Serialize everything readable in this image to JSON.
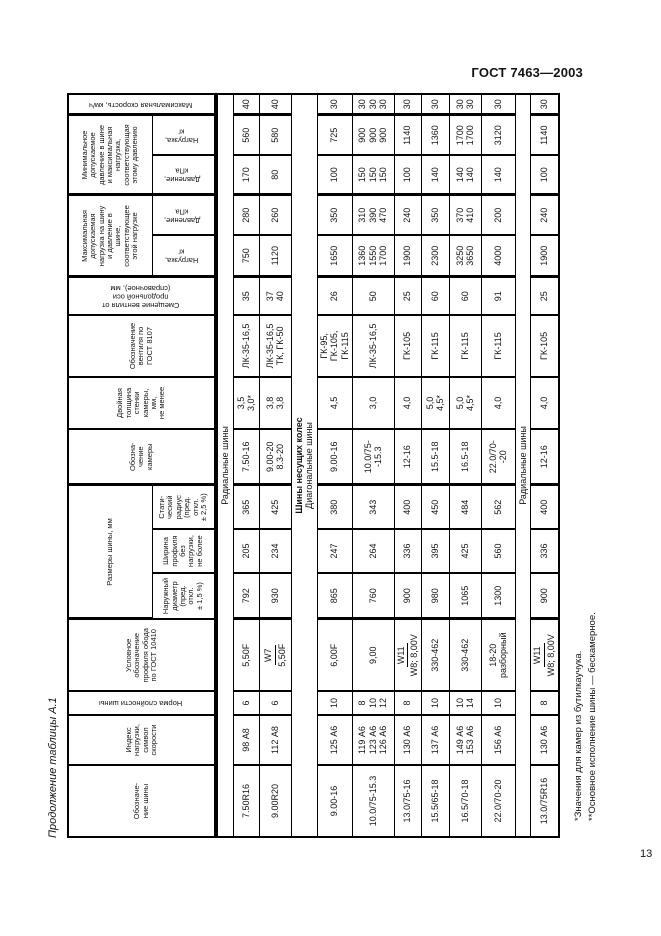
{
  "page": {
    "standard_ref": "ГОСТ 7463—2003",
    "page_number": "13"
  },
  "table": {
    "caption": "Продолжение таблицы А.1",
    "headers": {
      "tire_designation": "Обозначе-\nние шины",
      "load_index": "Индекс\nнагрузки,\nсимвол\nскорости",
      "ply_rating": "Норма слойности шины",
      "rim_profile": "Условное\nобозначение\nпрофиля обода\nпо ГОСТ 10410",
      "tire_dimensions_group": "Размеры шины, мм",
      "outer_diameter": "Наружный\nдиаметр\n(пред.\nоткл.\n± 1,5 %)",
      "profile_width": "Ширина\nпрофиля\nбез\nнагрузки,\nне более",
      "static_radius": "Стати-\nческий\nрадиус\n(пред.\nоткл.\n± 2,5 %)",
      "tube_designation": "Обозна-\nчение\nкамеры",
      "tube_wall_thickness": "Двойная\nтолщина\nстенки\nкамеры,\nмм,\nне менее",
      "valve_designation": "Обозначение\nвентиля по\nГОСТ 8107",
      "valve_offset": "Смещение вентиля от\nпродольной оси\n(справочное), мм",
      "max_load_group": "Максимальная\nдопускаемая\nнагрузка на шину\nи давление в\nшине,\nсоответствующее\nэтой нагрузке",
      "min_pressure_group": "Минимальное\nдопускаемое\nдавление в шине\nи максимальная\nнагрузка,\nсоответствующая\nэтому давлению",
      "load_kg_max": "Нагрузка,\nкг",
      "pressure_kpa_max": "Давление,\nкПа",
      "pressure_kpa_min": "Давление,\nкПа",
      "load_kg_min": "Нагрузка,\nкг",
      "max_speed": "Максимальная скорость, км/ч"
    },
    "rows": [
      {
        "section": [
          {
            "text": "Радиальные шины",
            "bold": false
          }
        ],
        "h": 14
      },
      {
        "h": 26,
        "cells": [
          "7.50R16",
          "98 А8",
          "6",
          "5,50F",
          "792",
          "205",
          "365",
          "7.50-16",
          "3,5\n3,0*",
          "ЛК-35-16,5",
          "35",
          "750",
          "280",
          "170",
          "560",
          "40"
        ]
      },
      {
        "h": 32,
        "cells": [
          "9.00R20",
          "112 А8",
          "6",
          {
            "frac": [
              "W7",
              "5,50F"
            ]
          },
          "930",
          "234",
          "425",
          "9.00-20\n8.3-20",
          "3,8\n3,8",
          "ЛК-35-16,5\nТК, ГК-50",
          "37\n40",
          "1120",
          "260",
          "80",
          "580",
          "40"
        ]
      },
      {
        "section": [
          {
            "text": "Шины несущих колес",
            "bold": true
          },
          {
            "text": "Диагональные шины",
            "bold": false
          }
        ],
        "h": 24
      },
      {
        "h": 32,
        "cells": [
          "9.00-16",
          "125 А6",
          "10",
          "6,00F",
          "865",
          "247",
          "380",
          "9.00-16",
          "4,5",
          "ГК-95,\nГК-105,\nГК-115",
          "26",
          "1650",
          "350",
          "100",
          "725",
          "30"
        ]
      },
      {
        "h": 42,
        "cells": [
          "10.0/75-15.3",
          "119 А6\n123 А6\n126 А6",
          "8\n10\n12",
          "9,00",
          "760",
          "264",
          "343",
          "10.0/75-\n-15.3",
          "3,0",
          "ЛК-35-16,5",
          "50",
          "1360\n1550\n1700",
          "310\n390\n470",
          "150\n150\n150",
          "900\n900\n900",
          "30\n30\n30"
        ]
      },
      {
        "h": 26,
        "cells": [
          "13.0/75-16",
          "130 А6",
          "8",
          {
            "frac": [
              "W11",
              "W8; 8,00V"
            ]
          },
          "900",
          "336",
          "400",
          "12-16",
          "4,0",
          "ГК-105",
          "25",
          "1900",
          "240",
          "100",
          "1140",
          "30"
        ]
      },
      {
        "h": 28,
        "cells": [
          "15.5/65-18",
          "137 А6",
          "10",
          "330-462",
          "980",
          "395",
          "450",
          "15.5-18",
          "5,0\n4,5*",
          "ГК-115",
          "60",
          "2300",
          "350",
          "140",
          "1360",
          "30"
        ]
      },
      {
        "h": 32,
        "cells": [
          "16.5/70-18",
          "149 А6\n153 А6",
          "10\n14",
          "330-462",
          "1065",
          "425",
          "484",
          "16.5-18",
          "5,0\n4,5*",
          "ГК-115",
          "60",
          "3250\n3650",
          "370\n410",
          "140\n140",
          "1700\n1700",
          "30\n30"
        ]
      },
      {
        "h": 34,
        "cells": [
          "22.0/70-20",
          "156 А6",
          "10",
          "18-20\nразборный",
          "1300",
          "560",
          "562",
          "22.0/70-\n-20",
          "4,0",
          "ГК-115",
          "91",
          "4000",
          "200",
          "140",
          "3120",
          "30"
        ]
      },
      {
        "section": [
          {
            "text": "Радиальные шины",
            "bold": false
          }
        ],
        "h": 14
      },
      {
        "h": 26,
        "cells": [
          "13.0/75R16",
          "130 А6",
          "8",
          {
            "frac": [
              "W11",
              "W8; 8,00V"
            ]
          },
          "900",
          "336",
          "400",
          "12-16",
          "4,0",
          "ГК-105",
          "25",
          "1900",
          "240",
          "100",
          "1140",
          "30"
        ]
      }
    ],
    "footnotes": [
      "*Значения для камер из бутилкаучука.",
      "**Основное исполнение шины — бескамерное."
    ]
  }
}
